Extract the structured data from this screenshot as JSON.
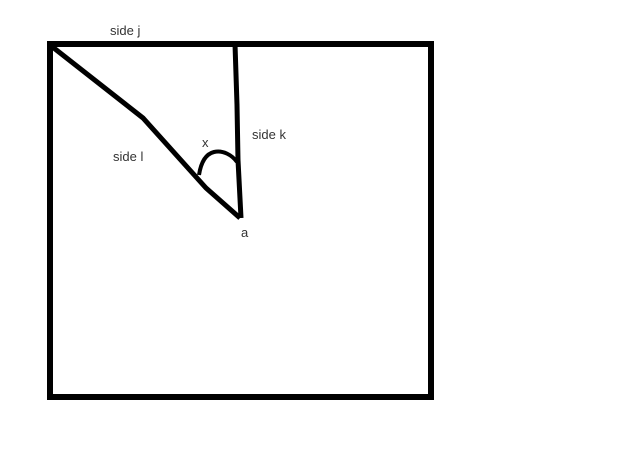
{
  "diagram": {
    "background": "#ffffff",
    "ink_color": "#000000",
    "text_color": "#333333",
    "labels": {
      "side_j": "side j",
      "side_k": "side k",
      "side_l": "side l",
      "angle_x": "x",
      "vertex_a": "a"
    }
  }
}
